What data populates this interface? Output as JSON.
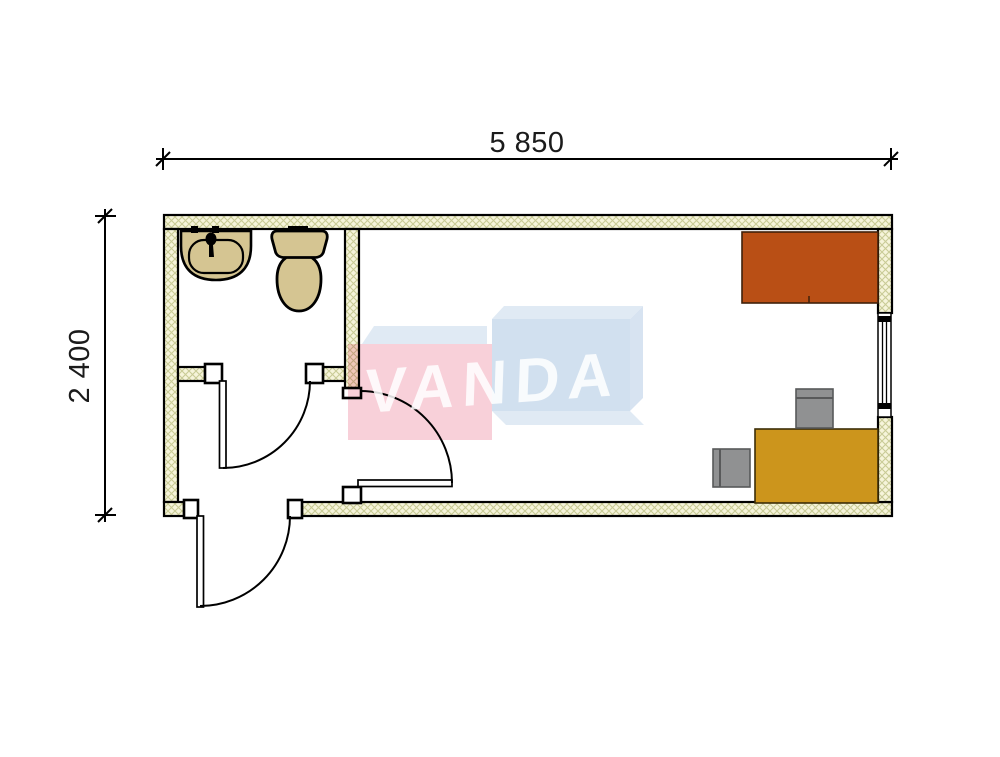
{
  "dimensions": {
    "width_label": "5 850",
    "height_label": "2 400"
  },
  "watermark": {
    "text": "VANDA",
    "pink": "#f6c5d0",
    "blue": "#c6d9eb",
    "blue_light": "#d9e5f1",
    "blue_side": "#cddcee",
    "text_color": "#ffffff"
  },
  "colors": {
    "background": "#ffffff",
    "line": "#000000",
    "wall_fill": "#f6f4da",
    "wall_hatch": "#c9cb96",
    "fixture_fill": "#d5c592",
    "wardrobe": "#b94f15",
    "desk": "#cc951c",
    "chair_fill": "#909192",
    "chair_border": "#58595a"
  },
  "icons": {
    "sink": "sink-plan-symbol",
    "toilet": "toilet-plan-symbol",
    "door": "door-swing-symbol",
    "window": "window-plan-symbol"
  }
}
